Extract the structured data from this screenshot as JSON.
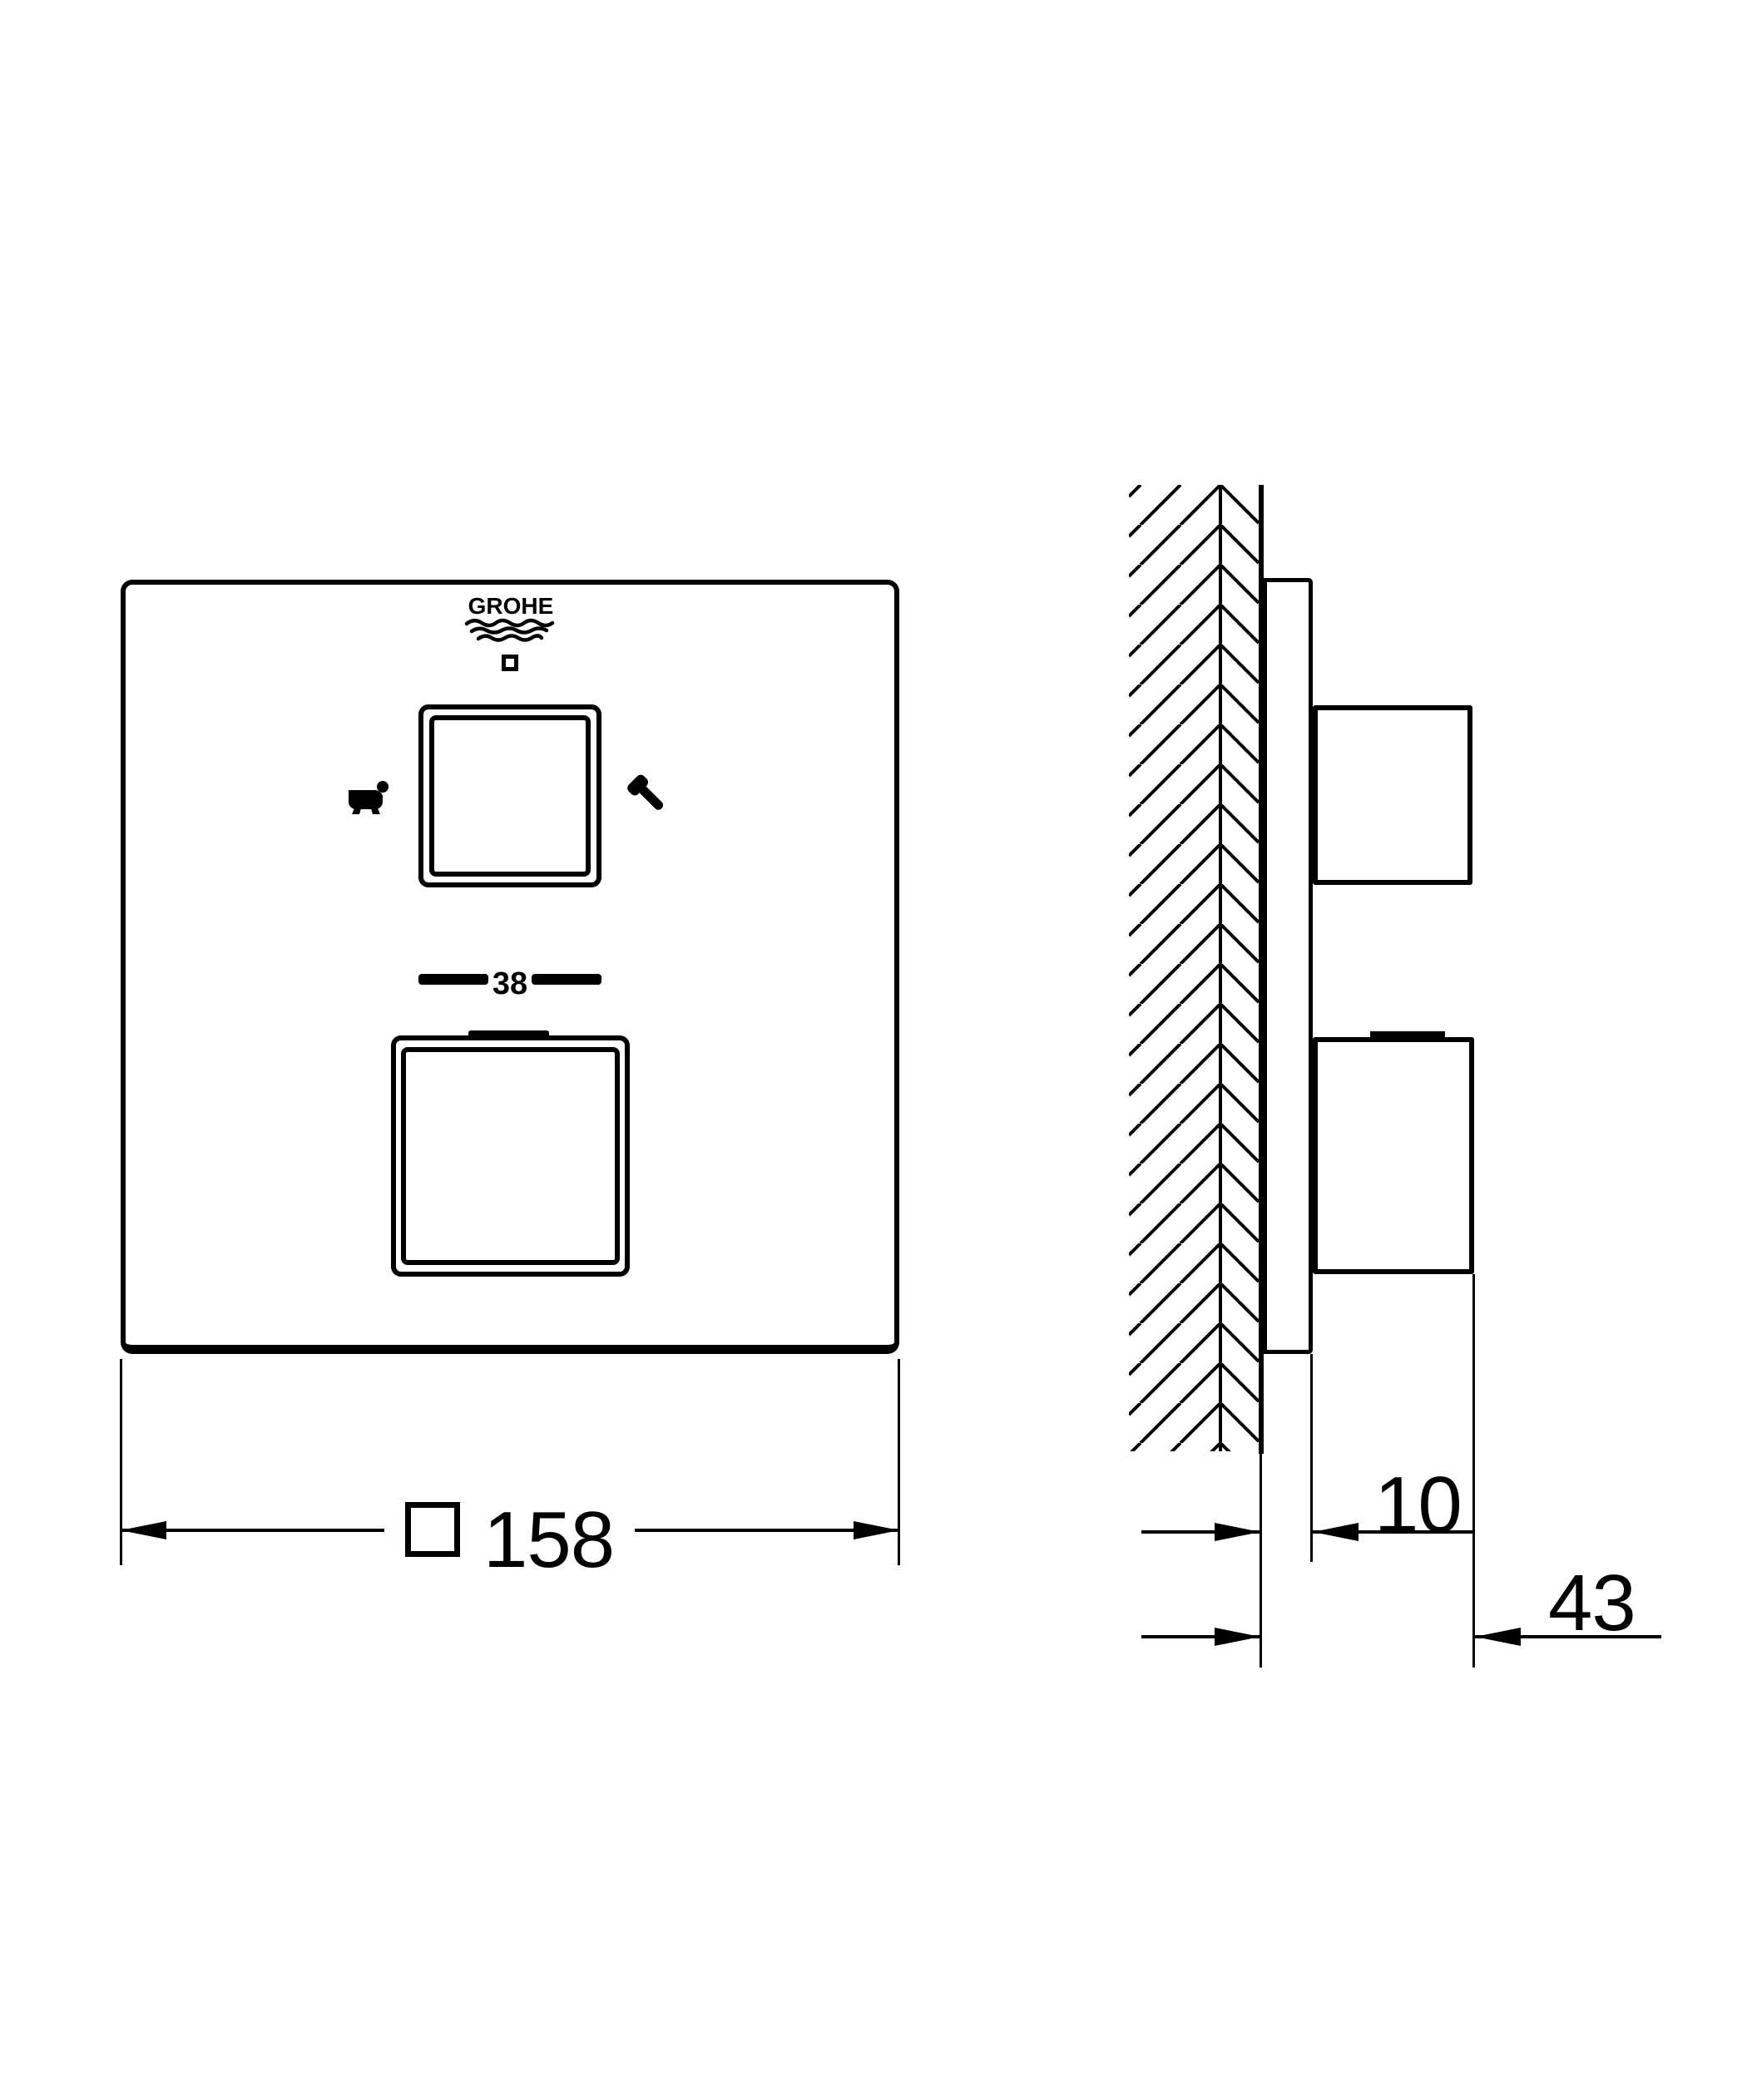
{
  "colors": {
    "ink": "#000000",
    "paper": "#ffffff"
  },
  "front_view": {
    "brand": "GROHE",
    "temperature_value": "38",
    "width_symbol": "□",
    "width_value": "158"
  },
  "side_view": {
    "plate_depth": "10",
    "total_depth": "43"
  },
  "icons": {
    "logo_waves": "grohe-waves-icon",
    "logo_square": "square-marker-icon",
    "left_outlet": "bathtub-icon",
    "right_outlet": "handshower-icon",
    "wall": "wall-hatch-pattern"
  }
}
